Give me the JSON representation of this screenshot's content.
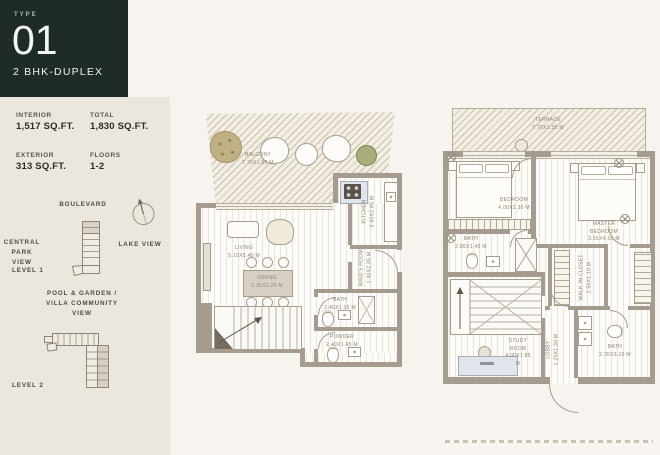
{
  "type_card": {
    "type_label": "TYPE",
    "type_number": "01",
    "type_name": "2 BHK-DUPLEX"
  },
  "stats": {
    "interior_label": "INTERIOR",
    "interior_value": "1,517 SQ.FT.",
    "total_label": "TOTAL",
    "total_value": "1,830 SQ.FT.",
    "exterior_label": "EXTERIOR",
    "exterior_value": "313 SQ.FT.",
    "floors_label": "FLOORS",
    "floors_value": "1-2"
  },
  "orientation": {
    "boulevard": "BOULEVARD",
    "central_park_view": "CENTRAL PARK VIEW",
    "lake_view": "LAKE VIEW",
    "level1_label": "LEVEL 1",
    "pool_view_line1": "POOL & GARDEN /",
    "pool_view_line2": "VILLA COMMUNITY VIEW",
    "level2_label": "LEVEL 2"
  },
  "level1": {
    "balcony": {
      "name": "BALCONY",
      "dim": "7.70x1.60 M"
    },
    "living": {
      "name": "LIVING",
      "dim": "5.10x5.40 M"
    },
    "dining": {
      "name": "DINING",
      "dim": "5.35x2.20 M"
    },
    "kitchen": {
      "name": "KITCHEN",
      "dim": "3.60x2.85 M"
    },
    "maids_room": {
      "name": "MAID'S ROOM",
      "dim": "1.40x2.05 M"
    },
    "bath": {
      "name": "BATH",
      "dim": "2.40x1.35 M"
    },
    "powder": {
      "name": "POWDER",
      "dim": "2.40x1.45 M"
    }
  },
  "level2": {
    "terrace": {
      "name": "TERRACE",
      "dim": "7.70x1.35 M"
    },
    "bedroom": {
      "name": "BEDROOM",
      "dim": "4.00x3.30 M"
    },
    "master_bedroom": {
      "name": "MASTER BEDROOM",
      "dim": "3.55x4.30 M"
    },
    "bath": {
      "name": "BATH",
      "dim": "2.85x1.45 M"
    },
    "walk_in_closet": {
      "name": "WALK-IN CLOSET",
      "dim": "2.50x1.10 M"
    },
    "study_room": {
      "name": "STUDY ROOM",
      "dim": "4.00x1.85 M"
    },
    "lobby": {
      "name": "LOBBY",
      "dim": "1.20x1.30 M"
    },
    "bath_2": {
      "name": "BATH",
      "dim": "2.35x3.10 M"
    }
  },
  "colors": {
    "brand_dark": "#1e2b28",
    "wall": "#a59c8f",
    "paper": "#f7f4ef",
    "panel": "#ebe7de"
  }
}
